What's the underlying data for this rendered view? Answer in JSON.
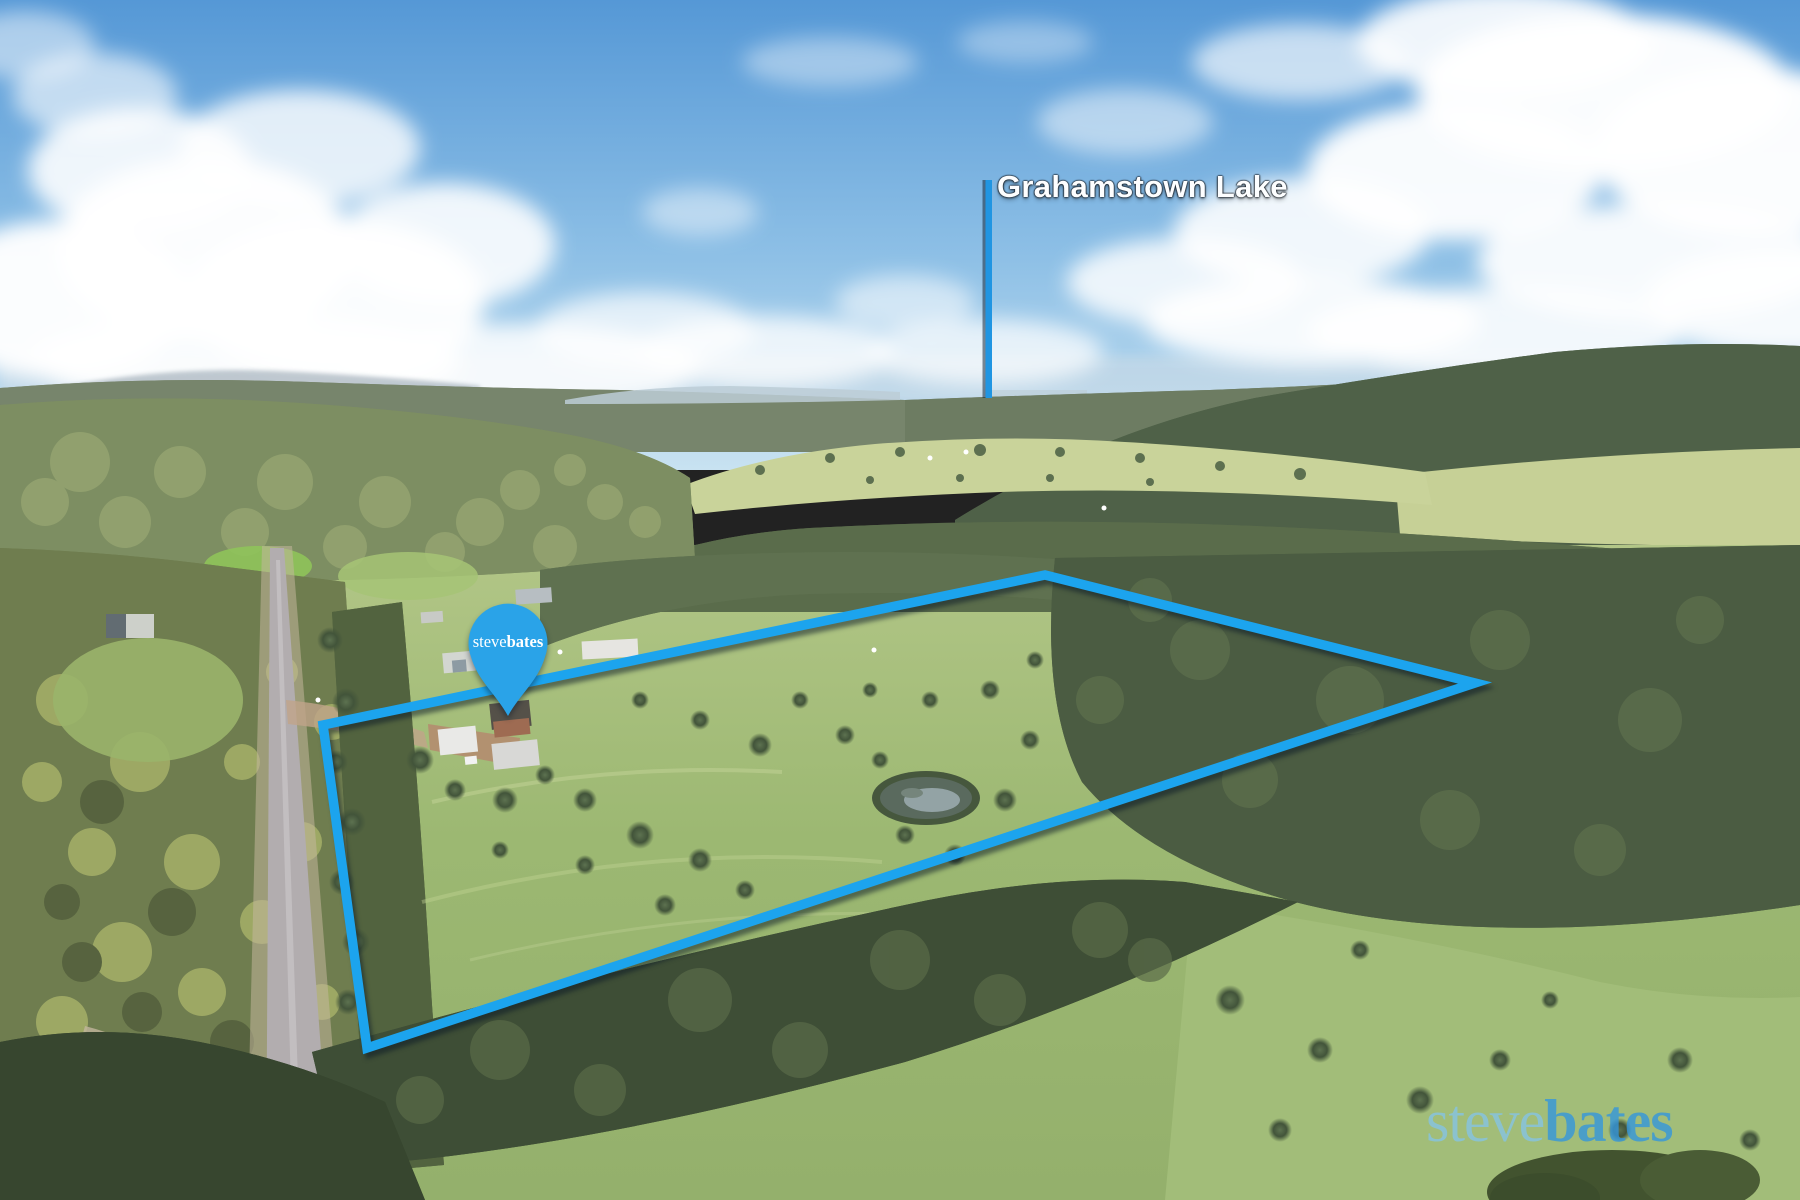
{
  "meta": {
    "type": "real-estate-aerial-photo",
    "scene_description": "Drone aerial photo of a rural acreage property with forest, paddocks, a dam, a country road on the left and a distant lake on the horizon under a blue sky with cumulus clouds"
  },
  "branding": {
    "agency_first": "steve",
    "agency_last": "bates",
    "accent_blue": "#1ca4ee"
  },
  "annotations": {
    "lake_label": "Grahamstown Lake",
    "lake_line_color": "#2095e2",
    "boundary_color": "#1ca4ee",
    "boundary_points_px": "323,725 1045,575 1475,683 367,1048",
    "pin": {
      "first": "steve",
      "last": "bates",
      "fill": "#2aa3e8"
    }
  },
  "icons": {
    "location_pin_icon": "teardrop balloon map marker"
  },
  "palette": {
    "sky_top": "#5598d6",
    "sky_horizon": "#c8e2f1",
    "cloud": "#ffffff",
    "far_ridge": "#77856c",
    "right_hill": "#4f6148",
    "mid_pasture": "#c9d39a",
    "property_pasture": "#9db974",
    "dark_forest": "#3e4e36",
    "gum_forest": "#6f7d4f",
    "road": "#b2adaf",
    "dirt": "#c2b59c",
    "pond_water": "#93a3a5"
  }
}
